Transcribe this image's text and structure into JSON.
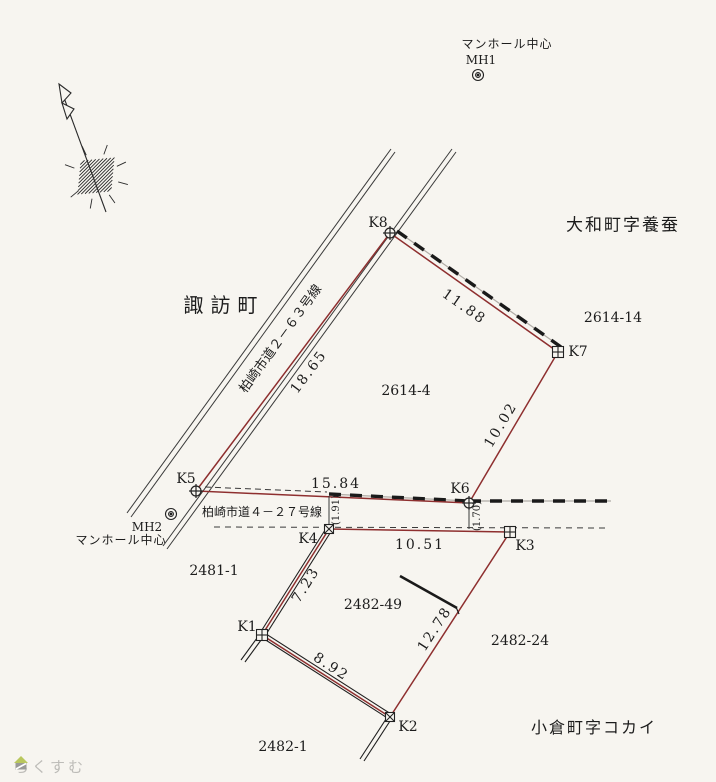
{
  "landmarks": {
    "mh1": {
      "caption": "マンホール中心",
      "id": "MH1"
    },
    "mh2": {
      "id": "MH2",
      "caption": "マンホール中心"
    }
  },
  "districts": {
    "yamato": "大和町字養蚕",
    "suwa": "諏訪町",
    "ogura": "小倉町字コカイ"
  },
  "roads": {
    "road263": "柏崎市道２－６３号線",
    "road427": "柏崎市道４－２７号線"
  },
  "parcels": {
    "p2614_4": "2614-4",
    "p2614_14": "2614-14",
    "p2481_1": "2481-1",
    "p2482_49": "2482-49",
    "p2482_24": "2482-24",
    "p2482_1": "2482-1"
  },
  "points": {
    "k1": "K1",
    "k2": "K2",
    "k3": "K3",
    "k4": "K4",
    "k5": "K5",
    "k6": "K6",
    "k7": "K7",
    "k8": "K8"
  },
  "dimensions": {
    "d_k5_k8": "18.65",
    "d_k8_k7": "11.88",
    "d_k7_k6": "10.02",
    "d_k5_k6": "15.84",
    "d_k4_k3": "10.51",
    "d_k4_k1": "7.23",
    "d_k3_k2": "12.78",
    "d_k1_k2": "8.92",
    "offset_k4": "(1.91)",
    "offset_k6": "(1.70)"
  },
  "colors": {
    "boundary_red": "#8e2f2f",
    "line_black": "#2a2a2a",
    "paper": "#f7f5f0"
  },
  "watermark": {
    "brand": "らくすむ"
  }
}
